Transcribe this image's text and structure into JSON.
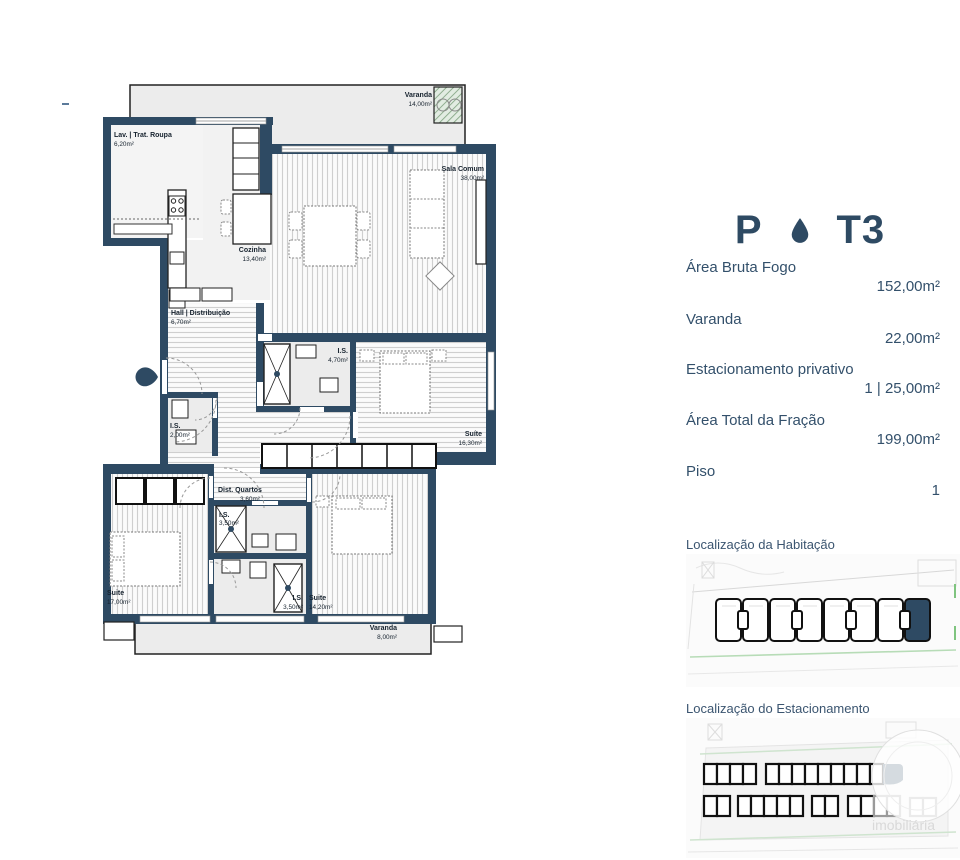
{
  "colors": {
    "navy": "#2e4a63",
    "wall": "#2e4a63",
    "floor_gray": "#ececec",
    "stripe_gray": "#cfcfcf",
    "site_green": "#b7dcb7",
    "text_navy": "#33506b"
  },
  "header": {
    "block": "P",
    "typology": "T3",
    "separator": "drop-icon"
  },
  "specs": [
    {
      "label": "Área Bruta Fogo",
      "value": "152,00m²"
    },
    {
      "label": "Varanda",
      "value": "22,00m²"
    },
    {
      "label": "Estacionamento privativo",
      "value": "1 | 25,00m²"
    },
    {
      "label": "Área Total da Fração",
      "value": "199,00m²"
    },
    {
      "label": "Piso",
      "value": "1"
    }
  ],
  "maps": {
    "habitacao_title": "Localização da Habitação",
    "estacionamento_title": "Localização do Estacionamento",
    "watermark": "imobiliária"
  },
  "plan": {
    "rooms": [
      {
        "name": "Varanda",
        "area": "14,00m²"
      },
      {
        "name": "Lav. | Trat. Roupa",
        "area": "6,20m²"
      },
      {
        "name": "Sala Comum",
        "area": "38,00m²"
      },
      {
        "name": "Cozinha",
        "area": "13,40m²"
      },
      {
        "name": "Hall | Distribuição",
        "area": "6,70m²"
      },
      {
        "name": "I.S.",
        "area": "4,70m²"
      },
      {
        "name": "Suíte",
        "area": "16,30m²"
      },
      {
        "name": "I.S.",
        "area": "2,00m²"
      },
      {
        "name": "Dist. Quartos",
        "area": "3,60m²"
      },
      {
        "name": "I.S.",
        "area": "3,50m²"
      },
      {
        "name": "Suite",
        "area": "17,00m²"
      },
      {
        "name": "I.S.",
        "area": "3,50m²"
      },
      {
        "name": "Suite",
        "area": "14,20m²"
      },
      {
        "name": "Varanda",
        "area": "8,00m²"
      }
    ]
  }
}
